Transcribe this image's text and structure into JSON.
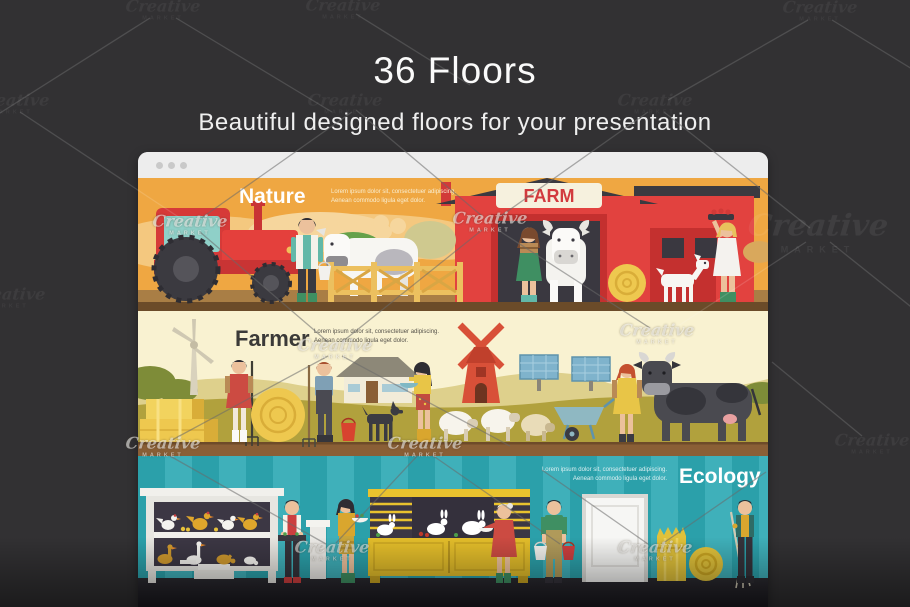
{
  "page": {
    "background_color": "#323133",
    "title": "36 Floors",
    "subtitle": "Beautiful designed floors for your presentation",
    "text_color": "#f5f5f5"
  },
  "watermark": {
    "brand": "Creative",
    "sub": "MARKET"
  },
  "browser_window": {
    "titlebar_color": "#ededed",
    "dot_color": "#c9c9c9",
    "dots": 3
  },
  "banners": {
    "nature": {
      "title": "Nature",
      "title_color": "#ffffff",
      "description": [
        "Lorem ipsum dolor sit, consectetuer adipiscing.",
        "Aenean commodo ligula eget dolor."
      ],
      "barn_sign": "FARM",
      "background_color": "#efa742",
      "ground_color": "#6b4b29",
      "scene": [
        "red-tractor",
        "farmer-with-bucket",
        "spotted-cow",
        "wooden-fence",
        "green-bushes",
        "red-barn",
        "farm-sign",
        "woman-in-green-overalls",
        "white-cow",
        "hay-bale",
        "white-goat",
        "woman-with-apple-tray"
      ]
    },
    "farmer": {
      "title": "Farmer",
      "title_color": "#3b3a38",
      "description": [
        "Lorem ipsum dolor sit, consectetuer adipiscing.",
        "Aenean commodo ligula eget dolor."
      ],
      "background_color": "#f9f2d1",
      "grass_color": "#b1a13d",
      "ground_color": "#8a5f36",
      "scene": [
        "wind-turbine",
        "hay-stack",
        "woman-with-pitchfork",
        "hay-roll",
        "farmer-with-pitchfork",
        "farmhouse",
        "red-bucket",
        "black-dog",
        "woman-with-bowl",
        "sheep-flock",
        "red-windmill",
        "solar-panels",
        "wheelbarrow",
        "girl-in-yellow-dress",
        "black-cow"
      ]
    },
    "ecology": {
      "title": "Ecology",
      "title_color": "#ffffff",
      "description": [
        "Lorem ipsum dolor sit, consectetuer adipiscing.",
        "Aenean commodo ligula eget dolor."
      ],
      "background_color": "#2ba0aa",
      "stripe_color": "#3fb0ba",
      "floor_color": "#2b2a30",
      "scene": [
        "poultry-showcase",
        "man-with-vegetable-tray",
        "white-pedestal",
        "woman-with-vegetable-bowl",
        "rabbit-hutch",
        "woman-feeding-rabbit",
        "man-with-buckets",
        "white-door",
        "straw-sack",
        "hay-roll",
        "man-with-pitchfork"
      ]
    }
  }
}
